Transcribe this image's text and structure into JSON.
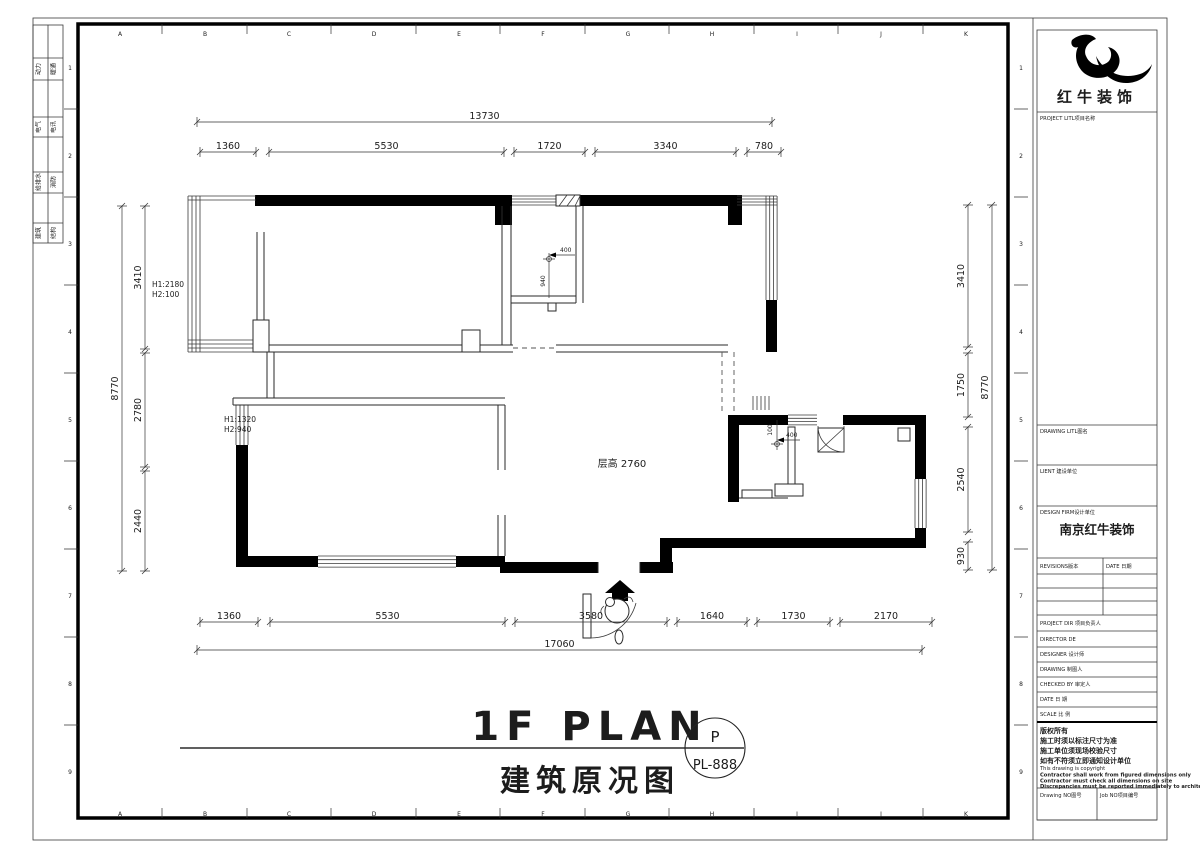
{
  "sheet": {
    "grid_letters": [
      "A",
      "B",
      "C",
      "D",
      "E",
      "F",
      "G",
      "H",
      "I",
      "J",
      "K"
    ],
    "grid_numbers": [
      "1",
      "2",
      "3",
      "4",
      "5",
      "6",
      "7",
      "8",
      "9"
    ],
    "stamps": [
      {
        "a": "动力",
        "b": "暖通"
      },
      {
        "a": "电气",
        "b": "电讯"
      },
      {
        "a": "给排水",
        "b": "消防"
      },
      {
        "a": "建筑",
        "b": "结构"
      }
    ]
  },
  "logo": {
    "name": "红牛装饰"
  },
  "titleblock": {
    "project_label": "PROJECT LITL项目名称",
    "drawing_label": "DRAWING LITL图名",
    "client_label": "LIENT 建设单位",
    "firm_label": "DESIGN FIRM设计单位",
    "firm_name": "南京红牛装饰",
    "revisions_label": "REVISIONS版本",
    "date_label": "DATE 日期",
    "rows": [
      "PROJECT DIR 项目负责人",
      "DIRECTOR DE",
      "DESIGNER    设计师",
      "DRAWING    制图人",
      "CHECKED BY 审定人",
      "DATE       日 期",
      "SCALE      比 例"
    ],
    "copyright_cn": [
      "版权所有",
      "施工时须以标注尺寸为准",
      "施工单位须现场校验尺寸",
      "如有不符须立即通知设计单位"
    ],
    "copyright_en": [
      "This drawing is copyright",
      "Contractor shall work from figured dimensions only",
      "Contractor must check all dimensions on site",
      "Discrepancies must be reported immediately to architects"
    ],
    "drawing_no_label": "Drawing NO图号",
    "job_no_label": "Job NO项目编号"
  },
  "title": {
    "en": "1F PLAN",
    "cn": "建筑原况图",
    "circle_top": "P",
    "circle_no": "PL-888"
  },
  "plan": {
    "dims_top_total": "13730",
    "dims_top": [
      "1360",
      "5530",
      "1720",
      "3340",
      "780"
    ],
    "dims_bottom": [
      "1360",
      "5530",
      "3580",
      "1640",
      "1730",
      "2170"
    ],
    "dims_bottom_total": "17060",
    "dims_left": [
      "3410",
      "2780",
      "2440"
    ],
    "dims_left_total": "8770",
    "dims_right": [
      "3410",
      "1750",
      "2540",
      "930"
    ],
    "dims_right_total": "8770",
    "room_height": "层高 2760",
    "window1": [
      "H1:2180",
      "H2:100"
    ],
    "window2": [
      "H1:1320",
      "H2:940"
    ],
    "micro1": {
      "h": "400",
      "v": "940"
    },
    "micro2": {
      "h": "400",
      "v": "100"
    }
  }
}
